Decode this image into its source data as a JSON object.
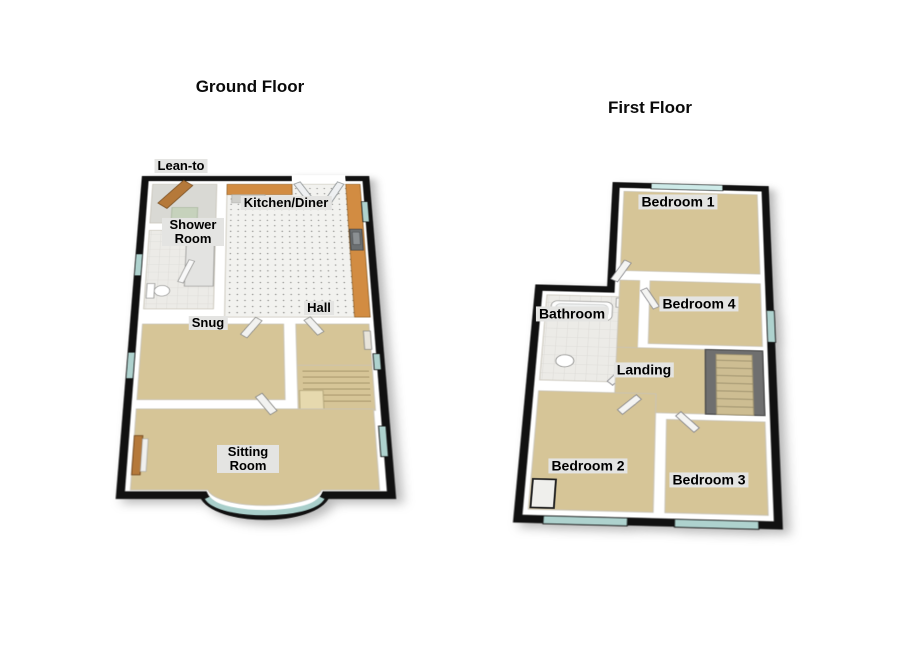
{
  "ground_floor": {
    "title": "Ground Floor",
    "rooms": [
      {
        "key": "lean-to",
        "label": "Lean-to"
      },
      {
        "key": "shower-room",
        "label": "Shower Room"
      },
      {
        "key": "kitchen-diner",
        "label": "Kitchen/Diner"
      },
      {
        "key": "snug",
        "label": "Snug"
      },
      {
        "key": "hall",
        "label": "Hall"
      },
      {
        "key": "sitting-room",
        "label": "Sitting Room"
      }
    ]
  },
  "first_floor": {
    "title": "First Floor",
    "rooms": [
      {
        "key": "bedroom-1",
        "label": "Bedroom 1"
      },
      {
        "key": "bathroom",
        "label": "Bathroom"
      },
      {
        "key": "bedroom-4",
        "label": "Bedroom 4"
      },
      {
        "key": "landing",
        "label": "Landing"
      },
      {
        "key": "bedroom-2",
        "label": "Bedroom 2"
      },
      {
        "key": "bedroom-3",
        "label": "Bedroom 3"
      }
    ]
  },
  "colors": {
    "background": "#ffffff",
    "wall_outline": "#111111",
    "wall_face": "#ffffff",
    "carpet_tan": "#d6c597",
    "kitchen_floor": "#f2f2ef",
    "window_glass": "#aed2ce",
    "counter_wood": "#d28c42",
    "door_wood": "#b5793a",
    "stairwell_gray": "#6f6f6f",
    "label_bg": "#e4e4e2",
    "label_text": "#000000"
  }
}
